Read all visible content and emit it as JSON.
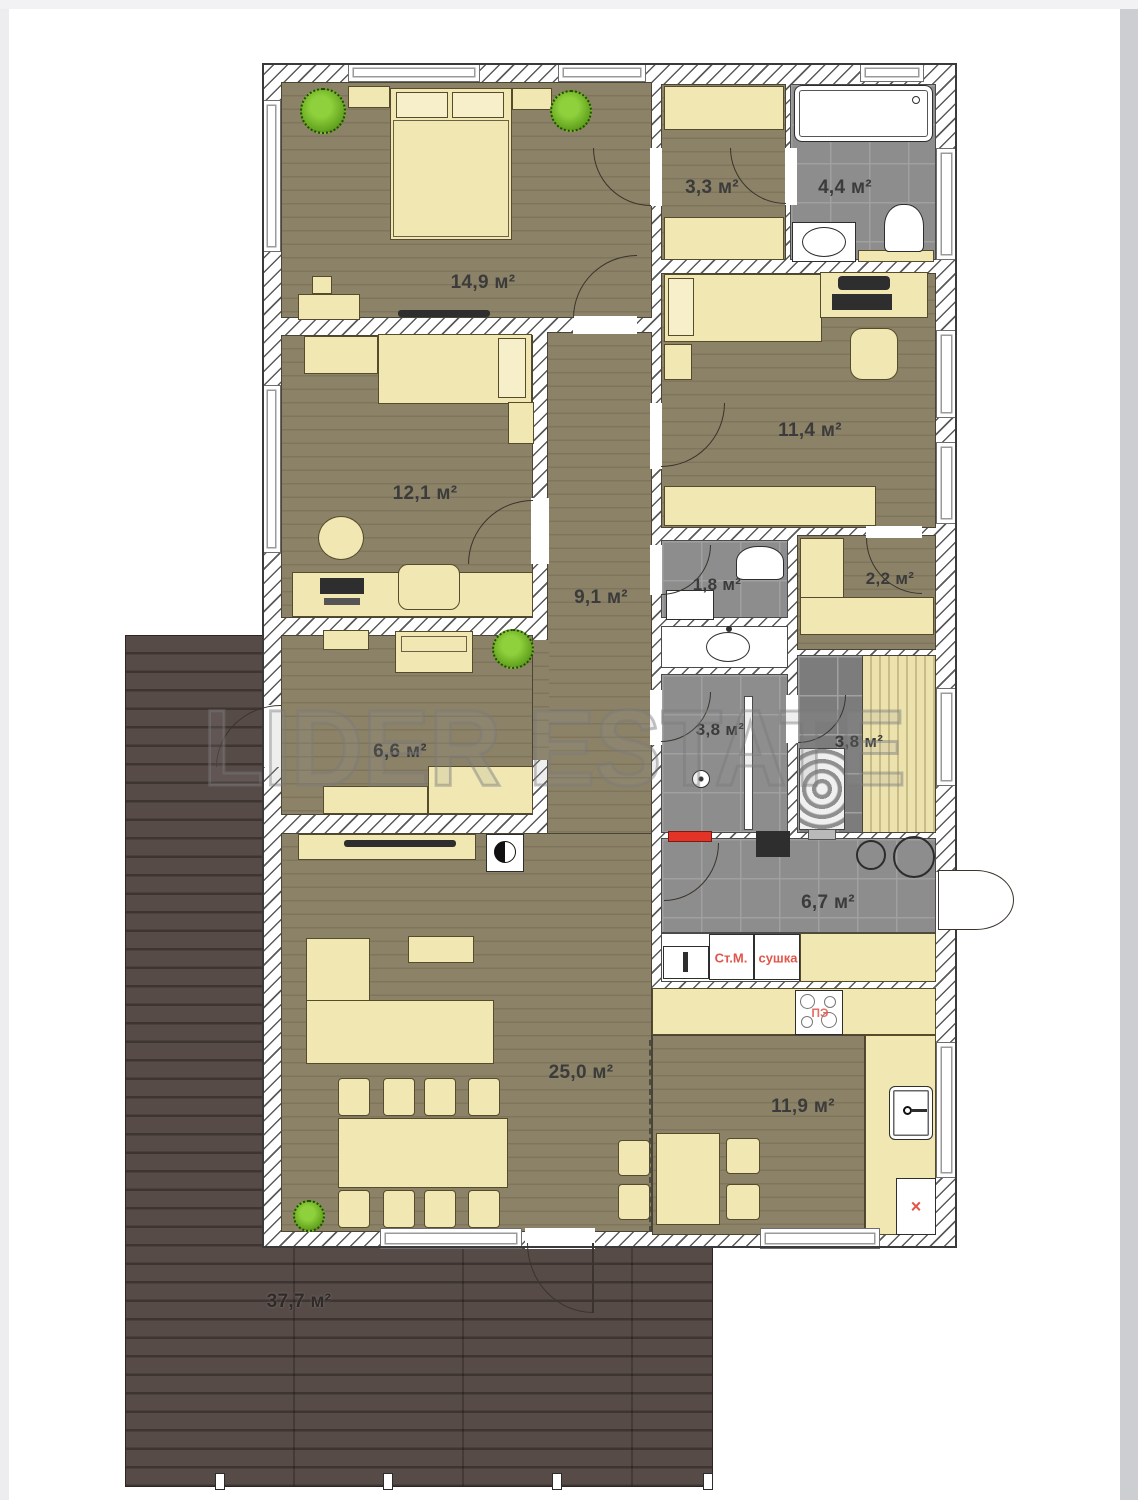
{
  "watermark": "LIDER ESTATE",
  "rooms": [
    {
      "name": "bedroom-1",
      "area": "14,9 м²"
    },
    {
      "name": "dressing-room",
      "area": "3,3 м²"
    },
    {
      "name": "bathroom",
      "area": "4,4 м²"
    },
    {
      "name": "bedroom-2",
      "area": "12,1 м²"
    },
    {
      "name": "bedroom-3",
      "area": "11,4 м²"
    },
    {
      "name": "hallway",
      "area": "9,1 м²"
    },
    {
      "name": "wc",
      "area": "1,8 м²"
    },
    {
      "name": "wardrobe",
      "area": "2,2 м²"
    },
    {
      "name": "entry-hall",
      "area": "6,6 м²"
    },
    {
      "name": "shower-room",
      "area": "3,8 м²"
    },
    {
      "name": "sauna",
      "area": "3,8 м²"
    },
    {
      "name": "utility-room",
      "area": "6,7 м²"
    },
    {
      "name": "living-room",
      "area": "25,0 м²"
    },
    {
      "name": "kitchen",
      "area": "11,9 м²"
    },
    {
      "name": "terrace",
      "area": "37,7 м²"
    }
  ],
  "appliance_labels": {
    "washing_machine": "Ст.М.",
    "dryer": "сушка",
    "stove": "ПЭ",
    "dishwasher_mark": "×"
  },
  "colors": {
    "floor_wood": "#8c8267",
    "terrace_wood": "#574b47",
    "tile_gray": "#8d8d8d",
    "furniture_yellow": "#f0e7b2",
    "area_label": "#3b3b3b",
    "red_label": "#e0564a",
    "plant_green": "#5f9e1d"
  }
}
